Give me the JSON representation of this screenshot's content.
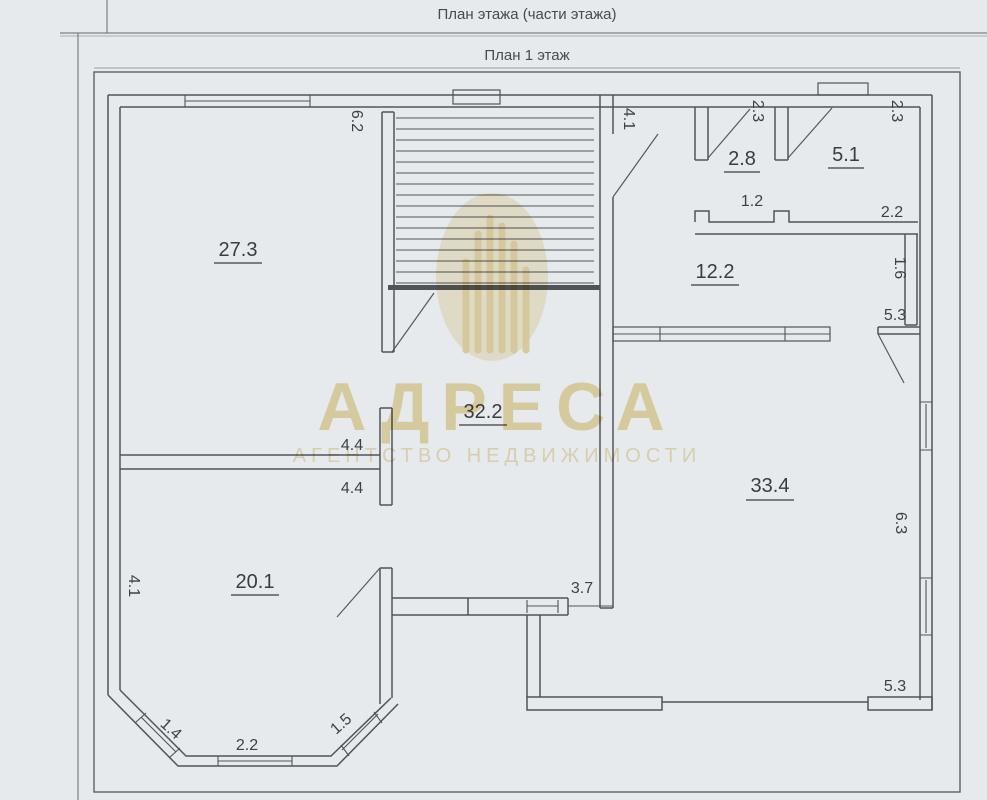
{
  "page": {
    "title": "План этажа (части этажа)",
    "subtitle": "План 1 этаж"
  },
  "watermark": {
    "brand": "АДРЕСА",
    "tagline": "АГЕНТСТВО НЕДВИЖИМОСТИ",
    "color": "#ecdcab"
  },
  "rooms": [
    {
      "area": "27.3"
    },
    {
      "area": "32.2"
    },
    {
      "area": "20.1"
    },
    {
      "area": "2.8"
    },
    {
      "area": "5.1"
    },
    {
      "area": "12.2"
    },
    {
      "area": "33.4"
    }
  ],
  "dimensions": [
    "6.2",
    "4.1",
    "2.3",
    "2.3",
    "1.2",
    "2.2",
    "1.6",
    "5.3",
    "4.4",
    "4.4",
    "6.3",
    "4.1",
    "3.7",
    "1.4",
    "2.2",
    "1.5",
    "5.3"
  ]
}
